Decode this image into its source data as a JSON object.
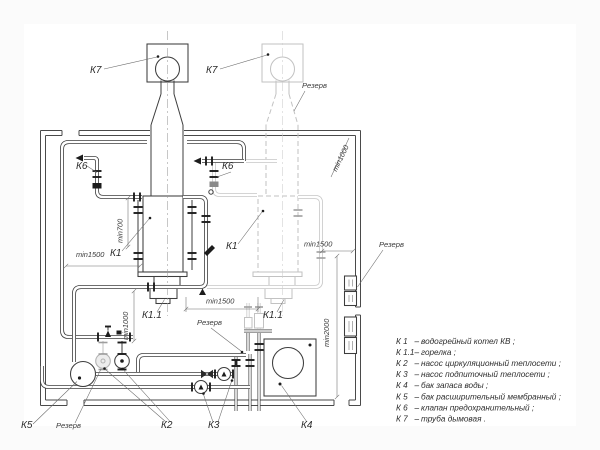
{
  "labels": {
    "k7": "К7",
    "k6": "К6",
    "k1": "К1",
    "k11": "К1.1",
    "k2": "К2",
    "k3": "К3",
    "k4": "К4",
    "k5": "К5",
    "reserve": "Резерв"
  },
  "dims": {
    "min700": "min700",
    "min1500": "min1500",
    "min1000": "min1000",
    "min2000": "min2000"
  },
  "legend": {
    "dash": "–",
    "items": [
      {
        "key": "К 1",
        "desc": "водогрейный котел КВ ;"
      },
      {
        "key": "К 1.1",
        "desc": "горелка ;"
      },
      {
        "key": "К 2",
        "desc": "насос циркуляционный теплосети ;"
      },
      {
        "key": "К 3",
        "desc": "насос подпиточный теплосети ;"
      },
      {
        "key": "К 4",
        "desc": "бак запаса воды ;"
      },
      {
        "key": "К 5",
        "desc": "бак расширительный мембранный ;"
      },
      {
        "key": "К 6",
        "desc": "клапан предохранительный ;"
      },
      {
        "key": "К 7",
        "desc": "труба дымовая ."
      }
    ]
  },
  "colors": {
    "line": "#3d3d3d",
    "reserve": "#c6c6c6",
    "paper": "#ffffff",
    "background": "#fbfbfb"
  }
}
